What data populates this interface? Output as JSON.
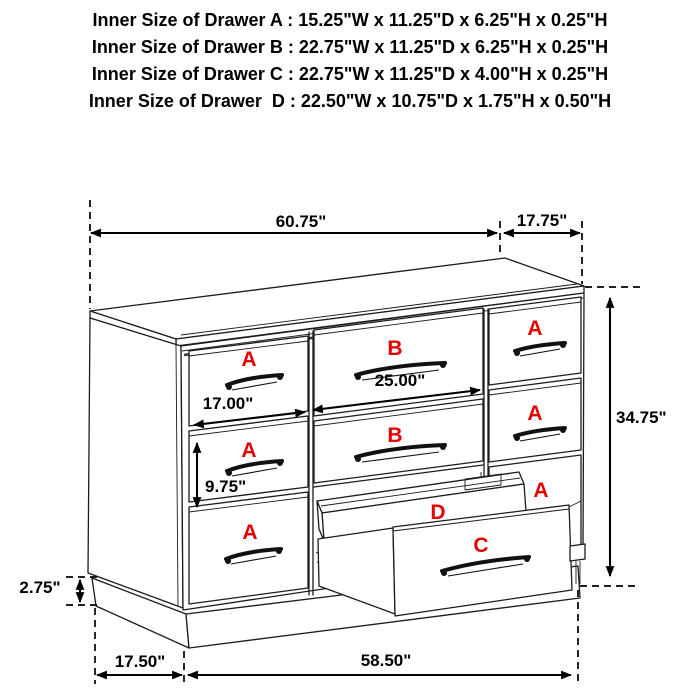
{
  "title_block": {
    "lines": [
      "Inner Size of Drawer A : 15.25\"W x 11.25\"D x 6.25\"H x 0.25\"H",
      "Inner Size of Drawer B : 22.75\"W x 11.25\"D x 6.25\"H x 0.25\"H",
      "Inner Size of Drawer C : 22.75\"W x 11.25\"D x 4.00\"H x 0.25\"H",
      "Inner Size of Drawer  D : 22.50\"W x 10.75\"D x 1.75\"H x 0.50\"H"
    ]
  },
  "dimensions": {
    "top_width": "60.75\"",
    "top_depth": "17.75\"",
    "overall_height": "34.75\"",
    "drawer_b_front_width": "25.00\"",
    "drawer_a_front_width": "17.00\"",
    "drawer_a_front_height": "9.75\"",
    "base_height": "2.75\"",
    "base_side_depth": "17.50\"",
    "base_front_width": "58.50\""
  },
  "drawer_letters": {
    "a": "A",
    "b": "B",
    "c": "C",
    "d": "D"
  },
  "colors": {
    "label_red": "#e60000",
    "line_black": "#1c1c1c",
    "background": "#ffffff"
  }
}
